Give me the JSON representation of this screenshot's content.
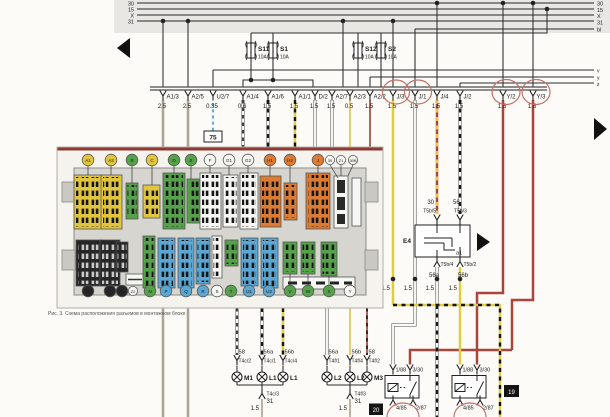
{
  "colors": {
    "bus": "#4b4b4b",
    "grey": "#afa494",
    "yellow": "#e0cb45",
    "red": "#a8463b",
    "blue": "#66aed6",
    "circle": "#c4706a",
    "band": "#e8e7e4",
    "paper": "#fcfbf8"
  },
  "buses": {
    "b30": "30",
    "b15": "15",
    "bx": "X",
    "b31": "31",
    "bbl": "bl",
    "v": "v",
    "y": "y",
    "z": "z"
  },
  "fuses": [
    {
      "name": "S11",
      "amp": "10A"
    },
    {
      "name": "S1",
      "amp": "10A"
    },
    {
      "name": "S12",
      "amp": "10A"
    },
    {
      "name": "S2",
      "amp": "10A"
    }
  ],
  "connectors": [
    {
      "label": "A1/3",
      "gauge": "2.5"
    },
    {
      "label": "A2/5",
      "gauge": "2.5"
    },
    {
      "label": "U2/7",
      "gauge": "0.35"
    },
    {
      "label": "A1/4",
      "gauge": "0.6"
    },
    {
      "label": "A1/6",
      "gauge": "1.5"
    },
    {
      "label": "A1/1",
      "gauge": "1.5"
    },
    {
      "label": "D/2",
      "gauge": "1.5"
    },
    {
      "label": "A2/7",
      "gauge": "1.5"
    },
    {
      "label": "A2/3",
      "gauge": "0.5"
    },
    {
      "label": "A2/2",
      "gauge": "1.5"
    },
    {
      "label": "J/3",
      "gauge": "1.5"
    },
    {
      "label": "J/1",
      "gauge": "1.5"
    },
    {
      "label": "J/4",
      "gauge": "1.5"
    },
    {
      "label": "J/2",
      "gauge": "1.5"
    },
    {
      "label": "Y/2",
      "gauge": "1.5"
    },
    {
      "label": "Y/3",
      "gauge": "1.5"
    }
  ],
  "refs": {
    "t75": "75",
    "b20": "20",
    "b19": "19"
  },
  "switch_e4": {
    "in1": "30",
    "in2": "56",
    "pin1": "T5b/5",
    "pin2": "T5b/3",
    "name": "E4",
    "contact": "a1",
    "pin3": "T5b/4",
    "pin4": "T5b/2",
    "out1": "56a",
    "out2": "56b"
  },
  "junction_gauges": [
    "1.5",
    "1.5",
    "1.5",
    "1.5"
  ],
  "lamp_groups": [
    {
      "terminals": [
        {
          "t": "58",
          "pin": "T4c/2"
        },
        {
          "t": "56a",
          "pin": "T4c/1"
        },
        {
          "t": "56b",
          "pin": "T4c/4"
        }
      ],
      "lamps": [
        "M1",
        "L1",
        "L1"
      ],
      "ground": {
        "pin": "T4c/3",
        "bus": "31",
        "gauge": "1.5"
      }
    },
    {
      "terminals": [
        {
          "t": "56a",
          "pin": "T4f/1"
        },
        {
          "t": "56b",
          "pin": "T4f/4"
        },
        {
          "t": "58",
          "pin": "T4f/2"
        }
      ],
      "lamps": [
        "L2",
        "L2",
        "M3"
      ],
      "ground": {
        "pin": "T4f/3",
        "bus": "31",
        "gauge": "1.5"
      }
    }
  ],
  "relays": [
    {
      "t1": "1/88",
      "t2": "3/30",
      "b1": "4/85",
      "b2": "2/87"
    },
    {
      "t1": "1/88",
      "t2": "3/30",
      "b1": "4/85",
      "b2": "2/87"
    }
  ],
  "inset": {
    "caption": "Рис. 3. Схема расположения разъемов в монтажном блоке",
    "top": [
      {
        "label": "A1",
        "color": "#e2c53e",
        "tcolor": "#111"
      },
      {
        "label": "A2",
        "color": "#e2c53e",
        "tcolor": "#111"
      },
      {
        "label": "B",
        "color": "#55a24a",
        "tcolor": "#111"
      },
      {
        "label": "C",
        "color": "#e2c53e",
        "tcolor": "#111"
      },
      {
        "label": "D",
        "color": "#55a24a",
        "tcolor": "#111"
      },
      {
        "label": "E",
        "color": "#55a24a",
        "tcolor": "#111"
      },
      {
        "label": "F",
        "color": "#f6f6f2",
        "tcolor": "#111"
      },
      {
        "label": "G1",
        "color": "#f6f6f2",
        "tcolor": "#111"
      },
      {
        "label": "G2",
        "color": "#f6f6f2",
        "tcolor": "#111"
      },
      {
        "label": "H1",
        "color": "#dd7b33",
        "tcolor": "#111"
      },
      {
        "label": "H2",
        "color": "#dd7b33",
        "tcolor": "#111"
      },
      {
        "label": "J",
        "color": "#dd7b33",
        "tcolor": "#111"
      },
      {
        "label": "30",
        "color": "#f6f6f2",
        "tcolor": "#111"
      },
      {
        "label": "Z1",
        "color": "#f6f6f2",
        "tcolor": "#111"
      },
      {
        "label": "30B",
        "color": "#f6f6f2",
        "tcolor": "#111"
      }
    ],
    "bottom": [
      {
        "label": "K",
        "color": "#262626",
        "tcolor": "#fff"
      },
      {
        "label": "L",
        "color": "#262626",
        "tcolor": "#fff"
      },
      {
        "label": "M",
        "color": "#262626",
        "tcolor": "#fff"
      },
      {
        "label": "Z2",
        "color": "#f6f6f2",
        "tcolor": "#111"
      },
      {
        "label": "N",
        "color": "#55a24a",
        "tcolor": "#111"
      },
      {
        "label": "P",
        "color": "#5ba7d4",
        "tcolor": "#111"
      },
      {
        "label": "Q",
        "color": "#5ba7d4",
        "tcolor": "#111"
      },
      {
        "label": "R",
        "color": "#5ba7d4",
        "tcolor": "#111"
      },
      {
        "label": "S",
        "color": "#f6f6f2",
        "tcolor": "#111"
      },
      {
        "label": "T",
        "color": "#55a24a",
        "tcolor": "#111"
      },
      {
        "label": "U1",
        "color": "#5ba7d4",
        "tcolor": "#111"
      },
      {
        "label": "U2",
        "color": "#5ba7d4",
        "tcolor": "#111"
      },
      {
        "label": "V",
        "color": "#55a24a",
        "tcolor": "#111"
      },
      {
        "label": "W",
        "color": "#55a24a",
        "tcolor": "#111"
      },
      {
        "label": "X",
        "color": "#55a24a",
        "tcolor": "#111"
      },
      {
        "label": "Y",
        "color": "#f6f6f2",
        "tcolor": "#111"
      }
    ]
  }
}
